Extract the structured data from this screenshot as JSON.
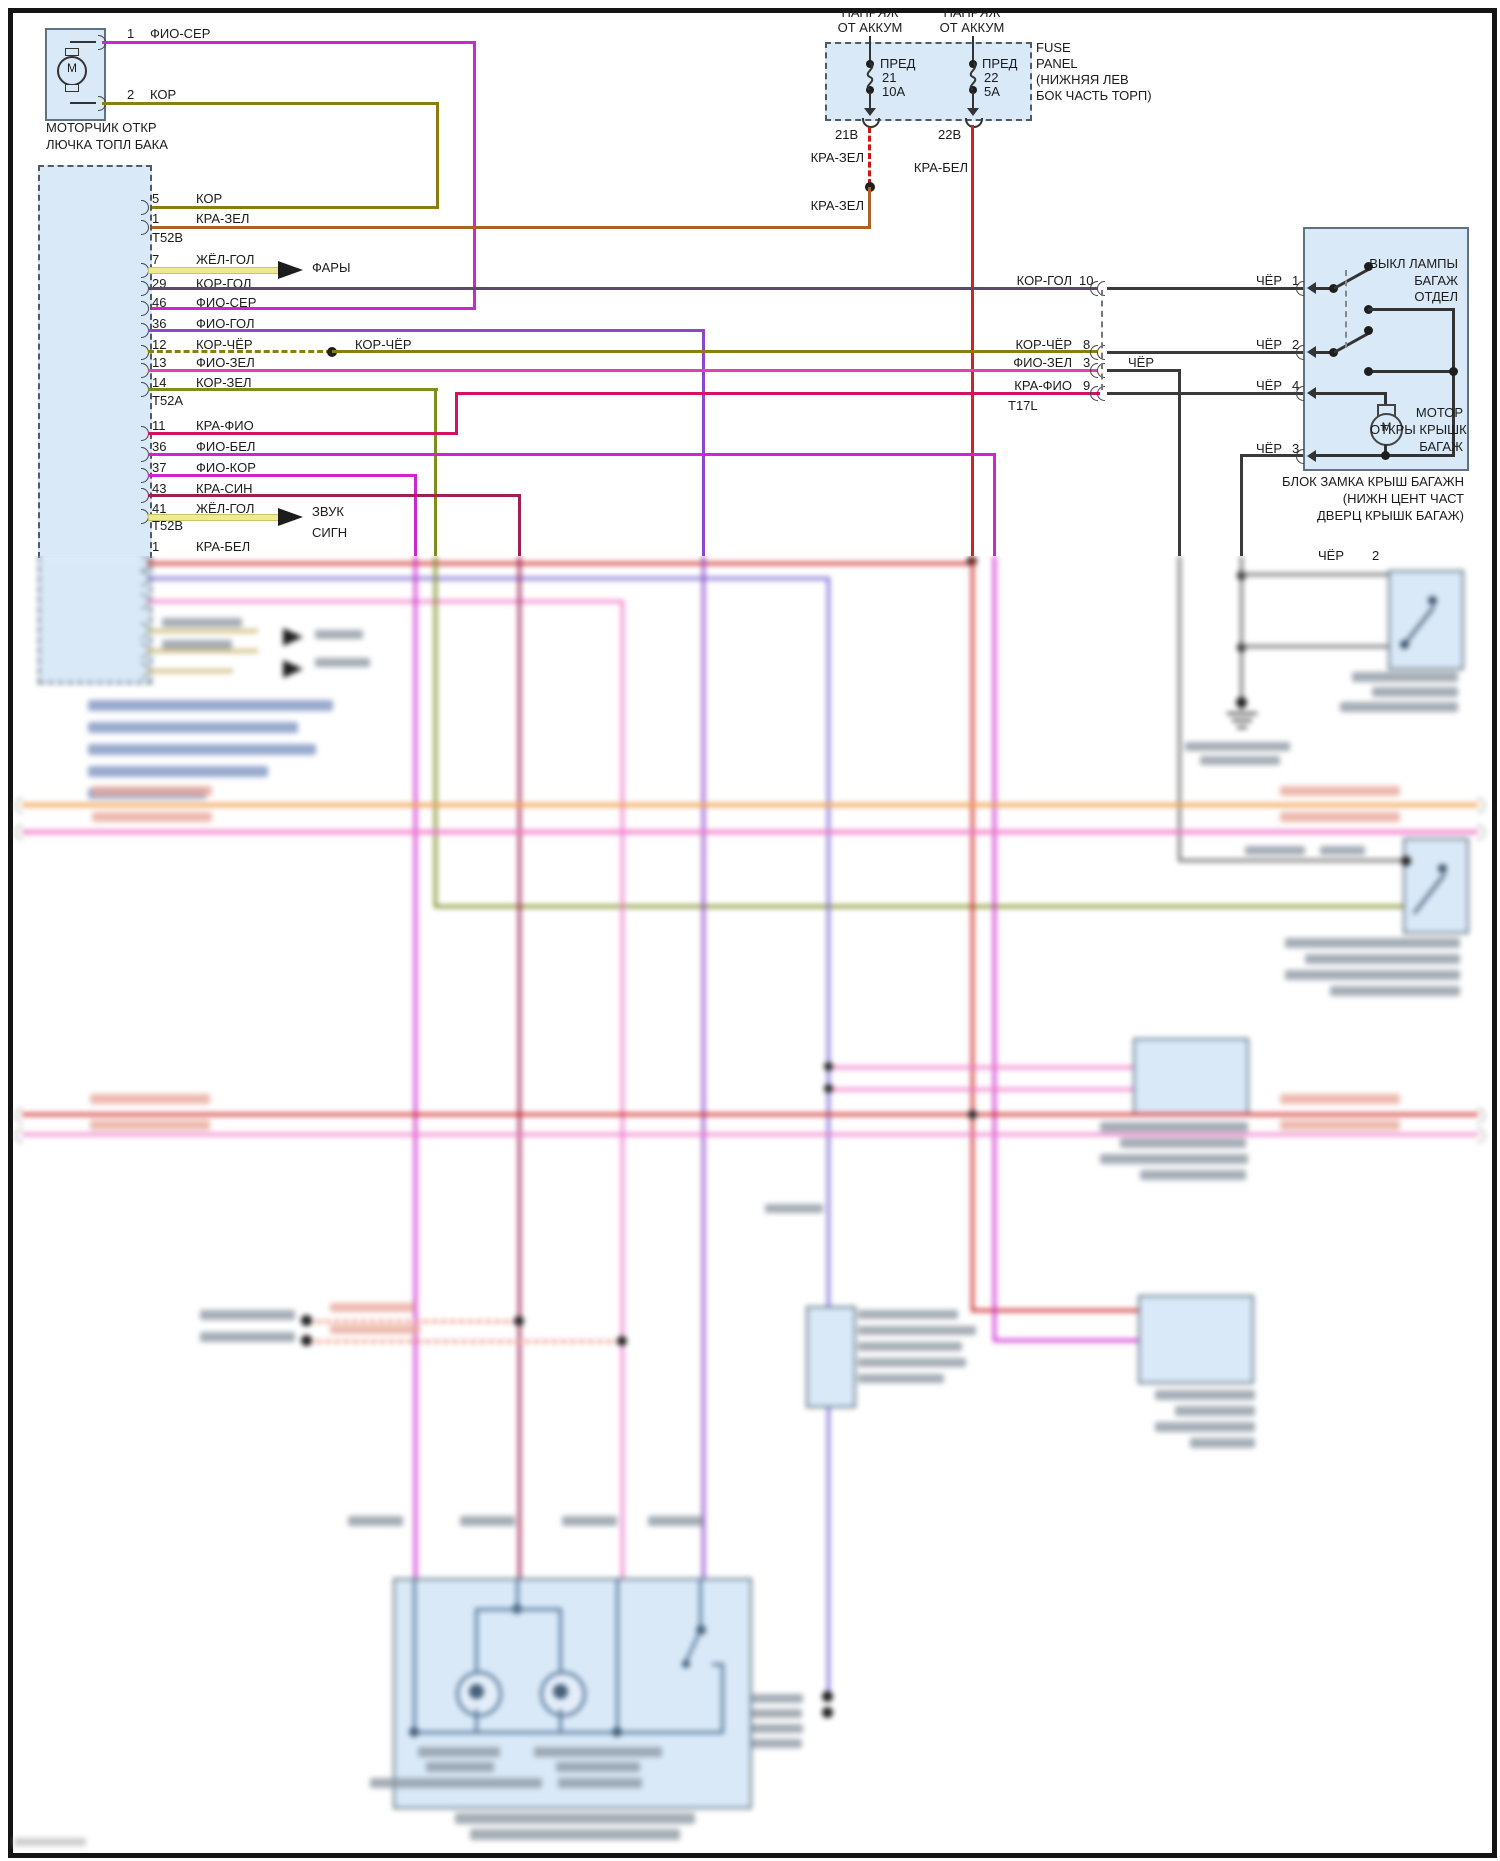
{
  "colors": {
    "text": "#1b1b1b",
    "box-fill": "#d9e9f8",
    "box-border": "#5f7282",
    "line-black": "#3a3a3a",
    "fio": "#cf25cf",
    "kor": "#8d7c12",
    "kra-zel": "#d01414",
    "kra-zel-solid": "#a8622a",
    "kra-bel": "#cf2424",
    "zhyol": "#eeea92",
    "kor-gol": "#5c4b68",
    "fio-gol": "#8d46cf",
    "fio-zel": "#e040b0",
    "kor-zel": "#7d8d1e",
    "kra-fio": "#d41264",
    "kra-sin": "#9e2150",
    "blue-wire": "#7d6cd4",
    "orange-wire": "#f2a558",
    "pink-wire": "#f07ac8",
    "salmon-wire": "#ee8f80",
    "gray-wire": "#6f6f6f",
    "tan-wire": "#d3bf86",
    "bar-gray": "#8d97a3",
    "bar-blue": "#7e94c2",
    "bar-salmon": "#e8a89a",
    "inner-wire": "#5a7a9a"
  },
  "motor_unit": {
    "pin1": "1",
    "pin1_wire": "ФИО-СЕР",
    "pin2": "2",
    "pin2_wire": "КОР",
    "m": "М",
    "name1": "МОТОРЧИК ОТКР",
    "name2": "ЛЮЧКА ТОПЛ БАКА"
  },
  "fuse_panel": {
    "supply_line1": "НАПРЯЖ",
    "supply_line2": "ОТ АККУМ",
    "fuse1": {
      "t": "ПРЕД",
      "n": "21",
      "a": "10А",
      "out": "21В",
      "wire": "КРА-ЗЕЛ",
      "wire2": "КРА-ЗЕЛ"
    },
    "fuse2": {
      "t": "ПРЕД",
      "n": "22",
      "a": "5А",
      "out": "22В",
      "wire": "КРА-БЕЛ"
    },
    "name": [
      "FUSE",
      "PANEL",
      "(НИЖНЯЯ ЛЕВ",
      "БОК ЧАСТЬ ТОРП)"
    ]
  },
  "connector": {
    "t52b": "T52B",
    "t52a": "T52A",
    "t52b2": "T52B",
    "pins": [
      {
        "n": "5",
        "w": "КОР"
      },
      {
        "n": "1",
        "w": "КРА-ЗЕЛ"
      },
      {
        "n": "7",
        "w": "ЖЁЛ-ГОЛ"
      },
      {
        "n": "29",
        "w": "КОР-ГОЛ"
      },
      {
        "n": "46",
        "w": "ФИО-СЕР"
      },
      {
        "n": "36",
        "w": "ФИО-ГОЛ"
      },
      {
        "n": "12",
        "w": "КОР-ЧЁР"
      },
      {
        "n": "13",
        "w": "ФИО-ЗЕЛ"
      },
      {
        "n": "14",
        "w": "КОР-ЗЕЛ"
      },
      {
        "n": "11",
        "w": "КРА-ФИО"
      },
      {
        "n": "36",
        "w": "ФИО-БЕЛ"
      },
      {
        "n": "37",
        "w": "ФИО-КОР"
      },
      {
        "n": "43",
        "w": "КРА-СИН"
      },
      {
        "n": "41",
        "w": "ЖЁЛ-ГОЛ"
      },
      {
        "n": "1",
        "w": "КРА-БЕЛ"
      }
    ],
    "kor_cher_mid": "КОР-ЧЁР",
    "arrow_fary": "ФАРЫ",
    "arrow_zvuk1": "ЗВУК",
    "arrow_zvuk2": "СИГН"
  },
  "right": {
    "rows": [
      {
        "w": "КОР-ГОЛ",
        "n": "10",
        "c": "ЧЁР",
        "cn": "1"
      },
      {
        "w": "КОР-ЧЁР",
        "n": "8",
        "c": "ЧЁР",
        "cn": "2"
      },
      {
        "w": "ФИО-ЗЕЛ",
        "n": "3",
        "c": "ЧЁР",
        "cn": ""
      },
      {
        "w": "КРА-ФИО",
        "n": "9",
        "c": "ЧЁР",
        "cn": "4"
      }
    ],
    "t17l": "T17L",
    "cher3": "ЧЁР",
    "cher3n": "3",
    "cher2": "ЧЁР",
    "cher2n": "2"
  },
  "block": {
    "sw1": [
      "ВЫКЛ ЛАМПЫ",
      "БАГАЖ",
      "ОТДЕЛ"
    ],
    "motor": [
      "МОТОР",
      "ОТКРЫ КРЫШК",
      "БАГАЖ"
    ],
    "m": "М",
    "caption": [
      "БЛОК ЗАМКА КРЫШ БАГАЖН",
      "(НИЖН ЦЕНТ ЧАСТ",
      "ДВЕРЦ КРЫШК БАГАЖ)"
    ]
  }
}
